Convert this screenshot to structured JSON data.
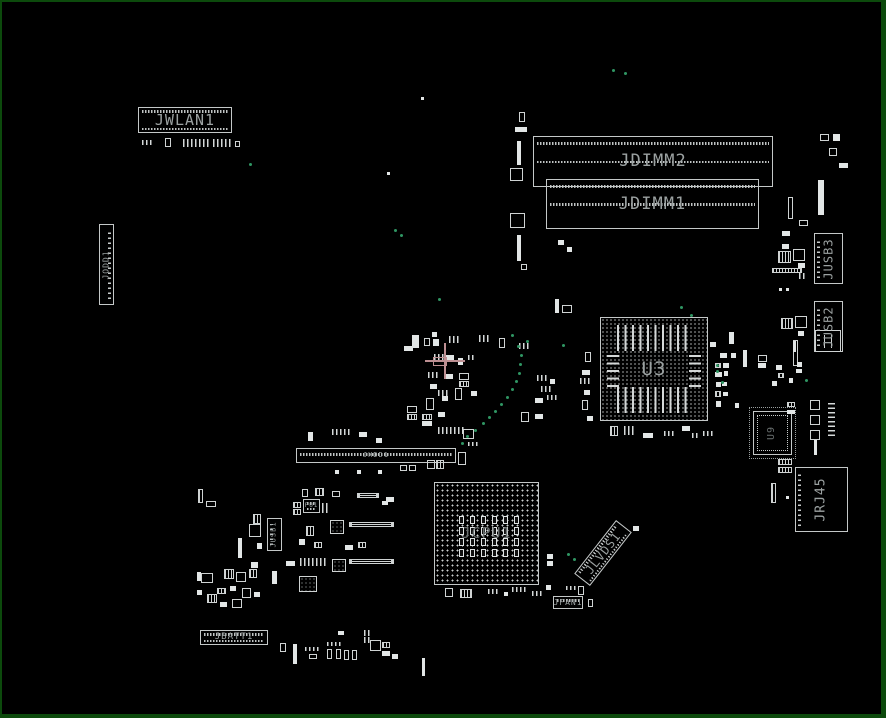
{
  "board": {
    "width": 886,
    "height": 718,
    "background": "#000000",
    "frame_color": "#0c4a0c",
    "outline_color": "#c4c8c8",
    "label_color": "#9ba1a1",
    "dim_label_color": "#6a7070",
    "green_dot_color": "#2f9663",
    "highlight_color": "#bd8f92"
  },
  "components": [
    {
      "id": "JWLAN1",
      "label": "JWLAN1",
      "type": "header",
      "x": 136,
      "y": 105,
      "w": 94,
      "h": 26,
      "fs": 15,
      "pins": "tb"
    },
    {
      "id": "JDIMM2",
      "label": "JDIMM2",
      "type": "dimm",
      "x": 531,
      "y": 134,
      "w": 240,
      "h": 51,
      "fs": 17
    },
    {
      "id": "JDIMM1",
      "label": "JDIMM1",
      "type": "dimm",
      "x": 544,
      "y": 177,
      "w": 213,
      "h": 50,
      "fs": 17
    },
    {
      "id": "JUSB3",
      "label": "JUSB3",
      "type": "vconn",
      "x": 812,
      "y": 231,
      "w": 29,
      "h": 51,
      "fs": 12,
      "lrot": -90,
      "pincol": "l"
    },
    {
      "id": "JUSB2",
      "label": "JUSB2",
      "type": "vconn",
      "x": 812,
      "y": 299,
      "w": 29,
      "h": 51,
      "fs": 12,
      "lrot": -90,
      "pincol": "l"
    },
    {
      "id": "U3",
      "label": "U3",
      "type": "bga",
      "x": 598,
      "y": 315,
      "w": 108,
      "h": 104,
      "fs": 19
    },
    {
      "id": "JODD1",
      "label": "JODD1",
      "type": "vconn",
      "x": 97,
      "y": 222,
      "w": 15,
      "h": 81,
      "fs": 8,
      "lrot": -90,
      "pincol": "r"
    },
    {
      "id": "JHDD1",
      "label": "JHDD1",
      "type": "header",
      "x": 294,
      "y": 446,
      "w": 160,
      "h": 15,
      "fs": 7,
      "pins": "m"
    },
    {
      "id": "JRJ45",
      "label": "JRJ45",
      "type": "vconn",
      "x": 793,
      "y": 465,
      "w": 53,
      "h": 65,
      "fs": 13,
      "lrot": -90,
      "pincol": "l"
    },
    {
      "id": "JCPU1",
      "label": "JCPU1",
      "type": "bga-cpu",
      "x": 432,
      "y": 480,
      "w": 105,
      "h": 103,
      "fs": 15
    },
    {
      "id": "JUSB1",
      "label": "JUSB1",
      "type": "vconn",
      "x": 265,
      "y": 516,
      "w": 15,
      "h": 33,
      "fs": 7,
      "lrot": -90,
      "pincol": "l"
    },
    {
      "id": "PU1",
      "label": "PU1",
      "type": "header",
      "x": 301,
      "y": 497,
      "w": 17,
      "h": 14,
      "fs": 6,
      "pins": "tb"
    },
    {
      "id": "JLVDS1",
      "label": "JLVDS1",
      "type": "diag",
      "x": 567,
      "y": 541,
      "w": 68,
      "h": 20,
      "fs": 12,
      "rot": -52
    },
    {
      "id": "JFAN1",
      "label": "JFAN1",
      "type": "header",
      "x": 551,
      "y": 594,
      "w": 30,
      "h": 13,
      "fs": 8,
      "pins": "t"
    },
    {
      "id": "JBATT1",
      "label": "JBATT1",
      "type": "header",
      "x": 198,
      "y": 628,
      "w": 68,
      "h": 15,
      "fs": 9,
      "pins": "tb"
    },
    {
      "id": "U9",
      "label": "U9",
      "type": "qfp",
      "x": 751,
      "y": 409,
      "w": 39,
      "h": 44,
      "fs": 10,
      "lrot": -90
    }
  ],
  "passives": [
    [
      140,
      138,
      12,
      5,
      "d"
    ],
    [
      163,
      136,
      6,
      9,
      "o"
    ],
    [
      181,
      137,
      26,
      8,
      "d"
    ],
    [
      211,
      137,
      20,
      8,
      "d"
    ],
    [
      233,
      139,
      5,
      6,
      "o"
    ],
    [
      419,
      95,
      3,
      3,
      "f"
    ],
    [
      385,
      170,
      3,
      3,
      "f"
    ],
    [
      513,
      125,
      12,
      5,
      "f"
    ],
    [
      517,
      110,
      6,
      10,
      "o"
    ],
    [
      515,
      139,
      4,
      24,
      "f"
    ],
    [
      508,
      166,
      13,
      13,
      "o"
    ],
    [
      508,
      211,
      15,
      15,
      "o"
    ],
    [
      515,
      233,
      4,
      26,
      "f"
    ],
    [
      519,
      262,
      6,
      6,
      "o"
    ],
    [
      797,
      218,
      9,
      6,
      "o"
    ],
    [
      818,
      132,
      9,
      7,
      "o"
    ],
    [
      831,
      132,
      7,
      7,
      "f"
    ],
    [
      827,
      146,
      8,
      8,
      "o"
    ],
    [
      837,
      161,
      9,
      5,
      "f"
    ],
    [
      816,
      178,
      6,
      35,
      "f"
    ],
    [
      786,
      195,
      5,
      22,
      "o"
    ],
    [
      780,
      229,
      8,
      5,
      "f"
    ],
    [
      780,
      242,
      7,
      5,
      "f"
    ],
    [
      776,
      249,
      13,
      12,
      "s"
    ],
    [
      791,
      247,
      12,
      12,
      "o"
    ],
    [
      796,
      261,
      7,
      5,
      "f"
    ],
    [
      770,
      266,
      30,
      5,
      "s"
    ],
    [
      797,
      271,
      8,
      6,
      "d"
    ],
    [
      777,
      286,
      3,
      3,
      "f"
    ],
    [
      784,
      286,
      3,
      3,
      "f"
    ],
    [
      779,
      316,
      12,
      11,
      "s"
    ],
    [
      793,
      314,
      12,
      12,
      "o"
    ],
    [
      796,
      329,
      6,
      5,
      "f"
    ],
    [
      791,
      338,
      5,
      26,
      "o"
    ],
    [
      813,
      328,
      26,
      22,
      "coil"
    ],
    [
      708,
      340,
      6,
      5,
      "f"
    ],
    [
      727,
      330,
      5,
      12,
      "f"
    ],
    [
      718,
      351,
      7,
      5,
      "f"
    ],
    [
      729,
      351,
      5,
      5,
      "f"
    ],
    [
      713,
      361,
      6,
      5,
      "s"
    ],
    [
      721,
      361,
      6,
      5,
      "f"
    ],
    [
      713,
      370,
      7,
      5,
      "f"
    ],
    [
      722,
      369,
      4,
      5,
      "f"
    ],
    [
      714,
      380,
      5,
      5,
      "f"
    ],
    [
      720,
      380,
      5,
      4,
      "f"
    ],
    [
      713,
      389,
      6,
      6,
      "s"
    ],
    [
      721,
      390,
      5,
      4,
      "f"
    ],
    [
      714,
      399,
      5,
      6,
      "f"
    ],
    [
      733,
      401,
      4,
      5,
      "f"
    ],
    [
      741,
      348,
      4,
      17,
      "f"
    ],
    [
      756,
      353,
      9,
      7,
      "o"
    ],
    [
      756,
      361,
      8,
      5,
      "f"
    ],
    [
      774,
      363,
      6,
      5,
      "f"
    ],
    [
      776,
      371,
      6,
      5,
      "s"
    ],
    [
      770,
      379,
      5,
      5,
      "f"
    ],
    [
      787,
      376,
      4,
      5,
      "f"
    ],
    [
      795,
      360,
      5,
      5,
      "f"
    ],
    [
      794,
      367,
      6,
      4,
      "f"
    ],
    [
      791,
      339,
      3,
      11,
      "f"
    ],
    [
      785,
      400,
      8,
      5,
      "s"
    ],
    [
      785,
      408,
      8,
      4,
      "f"
    ],
    [
      808,
      398,
      10,
      10,
      "o"
    ],
    [
      808,
      413,
      10,
      10,
      "o"
    ],
    [
      808,
      428,
      10,
      10,
      "o"
    ],
    [
      812,
      438,
      3,
      15,
      "f"
    ],
    [
      826,
      400,
      7,
      34,
      "dv"
    ],
    [
      583,
      350,
      6,
      10,
      "o"
    ],
    [
      580,
      368,
      8,
      5,
      "f"
    ],
    [
      578,
      376,
      10,
      6,
      "d"
    ],
    [
      582,
      388,
      6,
      5,
      "f"
    ],
    [
      580,
      398,
      6,
      10,
      "o"
    ],
    [
      585,
      414,
      6,
      5,
      "f"
    ],
    [
      608,
      424,
      8,
      10,
      "s"
    ],
    [
      622,
      424,
      10,
      9,
      "d"
    ],
    [
      641,
      431,
      10,
      5,
      "f"
    ],
    [
      662,
      429,
      12,
      5,
      "d"
    ],
    [
      680,
      424,
      8,
      5,
      "f"
    ],
    [
      690,
      431,
      8,
      5,
      "d"
    ],
    [
      701,
      429,
      10,
      5,
      "d"
    ],
    [
      410,
      333,
      7,
      13,
      "f"
    ],
    [
      402,
      344,
      9,
      5,
      "f"
    ],
    [
      422,
      336,
      6,
      8,
      "o"
    ],
    [
      431,
      337,
      6,
      7,
      "f"
    ],
    [
      430,
      330,
      5,
      5,
      "f"
    ],
    [
      447,
      334,
      11,
      7,
      "d"
    ],
    [
      432,
      352,
      10,
      6,
      "d"
    ],
    [
      444,
      353,
      8,
      5,
      "f"
    ],
    [
      456,
      356,
      5,
      7,
      "f"
    ],
    [
      466,
      353,
      8,
      5,
      "d"
    ],
    [
      426,
      370,
      12,
      6,
      "d"
    ],
    [
      444,
      372,
      7,
      5,
      "f"
    ],
    [
      457,
      371,
      10,
      7,
      "o"
    ],
    [
      457,
      379,
      10,
      6,
      "s"
    ],
    [
      428,
      382,
      7,
      5,
      "f"
    ],
    [
      436,
      388,
      10,
      6,
      "d"
    ],
    [
      424,
      396,
      8,
      12,
      "o"
    ],
    [
      440,
      394,
      6,
      5,
      "f"
    ],
    [
      453,
      386,
      7,
      12,
      "o"
    ],
    [
      469,
      389,
      6,
      5,
      "f"
    ],
    [
      420,
      412,
      10,
      6,
      "s"
    ],
    [
      420,
      419,
      10,
      5,
      "f"
    ],
    [
      436,
      410,
      7,
      5,
      "f"
    ],
    [
      405,
      404,
      10,
      7,
      "o"
    ],
    [
      405,
      412,
      10,
      6,
      "s"
    ],
    [
      436,
      425,
      26,
      7,
      "d"
    ],
    [
      461,
      427,
      11,
      10,
      "o"
    ],
    [
      477,
      333,
      10,
      7,
      "d"
    ],
    [
      497,
      336,
      6,
      10,
      "o"
    ],
    [
      517,
      341,
      10,
      6,
      "d"
    ],
    [
      535,
      373,
      10,
      6,
      "d"
    ],
    [
      539,
      384,
      10,
      6,
      "d"
    ],
    [
      548,
      377,
      5,
      5,
      "f"
    ],
    [
      533,
      396,
      8,
      5,
      "f"
    ],
    [
      545,
      393,
      10,
      5,
      "d"
    ],
    [
      519,
      410,
      8,
      10,
      "o"
    ],
    [
      533,
      412,
      8,
      5,
      "f"
    ],
    [
      553,
      297,
      4,
      14,
      "f"
    ],
    [
      560,
      303,
      10,
      8,
      "o"
    ],
    [
      556,
      238,
      6,
      5,
      "f"
    ],
    [
      565,
      245,
      5,
      5,
      "f"
    ],
    [
      306,
      430,
      5,
      9,
      "f"
    ],
    [
      330,
      427,
      18,
      6,
      "d"
    ],
    [
      357,
      430,
      8,
      5,
      "f"
    ],
    [
      374,
      436,
      6,
      5,
      "f"
    ],
    [
      333,
      468,
      4,
      4,
      "f"
    ],
    [
      355,
      468,
      4,
      4,
      "f"
    ],
    [
      376,
      468,
      4,
      4,
      "f"
    ],
    [
      398,
      463,
      7,
      6,
      "o"
    ],
    [
      407,
      463,
      7,
      6,
      "o"
    ],
    [
      425,
      458,
      8,
      9,
      "o"
    ],
    [
      434,
      458,
      8,
      9,
      "s"
    ],
    [
      456,
      450,
      8,
      13,
      "o"
    ],
    [
      466,
      440,
      10,
      4,
      "d"
    ],
    [
      300,
      487,
      6,
      8,
      "o"
    ],
    [
      313,
      486,
      9,
      8,
      "s"
    ],
    [
      330,
      489,
      8,
      6,
      "o"
    ],
    [
      291,
      500,
      8,
      6,
      "s"
    ],
    [
      291,
      507,
      8,
      6,
      "s"
    ],
    [
      320,
      501,
      6,
      10,
      "d"
    ],
    [
      251,
      512,
      8,
      10,
      "s"
    ],
    [
      247,
      522,
      12,
      13,
      "o"
    ],
    [
      236,
      536,
      4,
      20,
      "f"
    ],
    [
      255,
      541,
      5,
      6,
      "f"
    ],
    [
      304,
      524,
      8,
      10,
      "s"
    ],
    [
      297,
      537,
      6,
      6,
      "f"
    ],
    [
      312,
      540,
      8,
      6,
      "s"
    ],
    [
      298,
      556,
      26,
      8,
      "d"
    ],
    [
      284,
      559,
      9,
      5,
      "f"
    ],
    [
      297,
      574,
      18,
      16,
      "ic"
    ],
    [
      270,
      569,
      5,
      13,
      "f"
    ],
    [
      222,
      567,
      10,
      10,
      "s"
    ],
    [
      234,
      570,
      10,
      10,
      "o"
    ],
    [
      247,
      567,
      8,
      9,
      "s"
    ],
    [
      249,
      560,
      7,
      6,
      "f"
    ],
    [
      199,
      571,
      12,
      10,
      "o"
    ],
    [
      195,
      570,
      4,
      9,
      "f"
    ],
    [
      215,
      586,
      9,
      6,
      "s"
    ],
    [
      228,
      584,
      6,
      5,
      "f"
    ],
    [
      240,
      586,
      9,
      10,
      "o"
    ],
    [
      205,
      592,
      10,
      9,
      "s"
    ],
    [
      195,
      588,
      5,
      5,
      "f"
    ],
    [
      230,
      597,
      10,
      9,
      "o"
    ],
    [
      218,
      600,
      7,
      5,
      "f"
    ],
    [
      252,
      590,
      6,
      5,
      "f"
    ],
    [
      347,
      520,
      45,
      5,
      "rn"
    ],
    [
      347,
      557,
      45,
      5,
      "rn"
    ],
    [
      355,
      491,
      22,
      5,
      "rn"
    ],
    [
      384,
      495,
      8,
      5,
      "f"
    ],
    [
      380,
      499,
      6,
      4,
      "f"
    ],
    [
      328,
      518,
      14,
      14,
      "ic"
    ],
    [
      330,
      557,
      14,
      13,
      "ic"
    ],
    [
      343,
      543,
      8,
      5,
      "f"
    ],
    [
      356,
      540,
      8,
      6,
      "s"
    ],
    [
      196,
      487,
      5,
      14,
      "s"
    ],
    [
      204,
      499,
      10,
      6,
      "o"
    ],
    [
      291,
      642,
      4,
      20,
      "f"
    ],
    [
      303,
      645,
      16,
      4,
      "d"
    ],
    [
      307,
      652,
      8,
      5,
      "o"
    ],
    [
      325,
      640,
      16,
      4,
      "d"
    ],
    [
      325,
      647,
      5,
      10,
      "o"
    ],
    [
      334,
      647,
      5,
      10,
      "o"
    ],
    [
      342,
      648,
      5,
      10,
      "o"
    ],
    [
      350,
      648,
      5,
      10,
      "o"
    ],
    [
      336,
      629,
      6,
      4,
      "f"
    ],
    [
      362,
      628,
      8,
      6,
      "d"
    ],
    [
      362,
      635,
      8,
      6,
      "d"
    ],
    [
      368,
      638,
      11,
      11,
      "o"
    ],
    [
      380,
      640,
      8,
      6,
      "s"
    ],
    [
      380,
      649,
      8,
      5,
      "f"
    ],
    [
      390,
      652,
      6,
      5,
      "f"
    ],
    [
      420,
      656,
      3,
      18,
      "f"
    ],
    [
      278,
      641,
      6,
      9,
      "o"
    ],
    [
      564,
      584,
      10,
      4,
      "d"
    ],
    [
      576,
      584,
      6,
      9,
      "o"
    ],
    [
      586,
      597,
      5,
      8,
      "o"
    ],
    [
      545,
      552,
      6,
      5,
      "f"
    ],
    [
      545,
      559,
      6,
      5,
      "f"
    ],
    [
      544,
      583,
      5,
      5,
      "f"
    ],
    [
      631,
      524,
      6,
      5,
      "f"
    ],
    [
      443,
      586,
      8,
      9,
      "o"
    ],
    [
      458,
      587,
      12,
      9,
      "s"
    ],
    [
      486,
      587,
      10,
      5,
      "d"
    ],
    [
      502,
      590,
      4,
      4,
      "f"
    ],
    [
      510,
      585,
      14,
      5,
      "d"
    ],
    [
      530,
      589,
      11,
      5,
      "d"
    ],
    [
      776,
      457,
      14,
      6,
      "s"
    ],
    [
      776,
      465,
      14,
      6,
      "s"
    ],
    [
      769,
      481,
      5,
      20,
      "s"
    ],
    [
      784,
      494,
      3,
      3,
      "f"
    ]
  ],
  "green_dots": [
    [
      247,
      161
    ],
    [
      392,
      227
    ],
    [
      398,
      232
    ],
    [
      610,
      67
    ],
    [
      622,
      70
    ],
    [
      509,
      332
    ],
    [
      515,
      343
    ],
    [
      518,
      352
    ],
    [
      517,
      361
    ],
    [
      516,
      370
    ],
    [
      513,
      378
    ],
    [
      509,
      386
    ],
    [
      504,
      394
    ],
    [
      498,
      401
    ],
    [
      492,
      408
    ],
    [
      486,
      414
    ],
    [
      480,
      420
    ],
    [
      472,
      427
    ],
    [
      464,
      433
    ],
    [
      436,
      296
    ],
    [
      678,
      304
    ],
    [
      688,
      312
    ],
    [
      714,
      362
    ],
    [
      714,
      368
    ],
    [
      719,
      379
    ],
    [
      803,
      377
    ],
    [
      524,
      338
    ],
    [
      560,
      342
    ],
    [
      565,
      551
    ],
    [
      571,
      556
    ],
    [
      459,
      440
    ]
  ],
  "crosshair": {
    "cx": 443,
    "cy": 359,
    "h_len": 40,
    "v_len": 36,
    "box_w": 14,
    "box_h": 9
  }
}
